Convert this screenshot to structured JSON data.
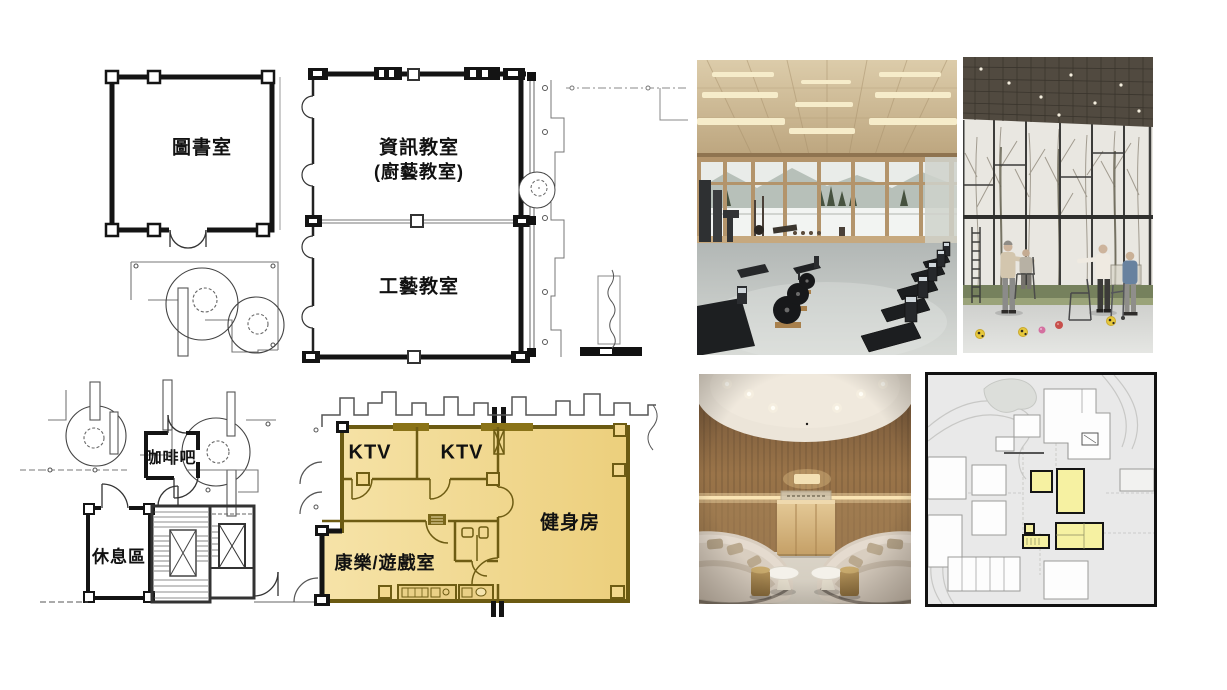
{
  "slide": {
    "background": "#ffffff"
  },
  "floor_plan": {
    "labels": {
      "library": "圖書室",
      "info_classroom": "資訊教室",
      "info_classroom_alt": "(廚藝教室)",
      "craft_classroom": "工藝教室",
      "coffee_bar": "咖啡吧",
      "rest_area": "休息區",
      "ktv_left": "KTV",
      "ktv_right": "KTV",
      "gym": "健身房",
      "recreation_room": "康樂/遊戲室"
    },
    "highlight": {
      "fill": "#f5e2a6",
      "fill_dark": "#eccf7c",
      "border": "#6b5a12"
    },
    "wall_color": "#1a1a1a"
  },
  "images": {
    "gym_photo": {
      "name": "gym-interior-photo"
    },
    "activity_photo": {
      "name": "activity-hall-photo"
    },
    "lounge_photo": {
      "name": "lounge-interior-photo"
    },
    "key_plan": {
      "name": "key-plan-mini-map",
      "highlight_fill": "#f6f1a2",
      "background": "#e9e9e9"
    }
  }
}
